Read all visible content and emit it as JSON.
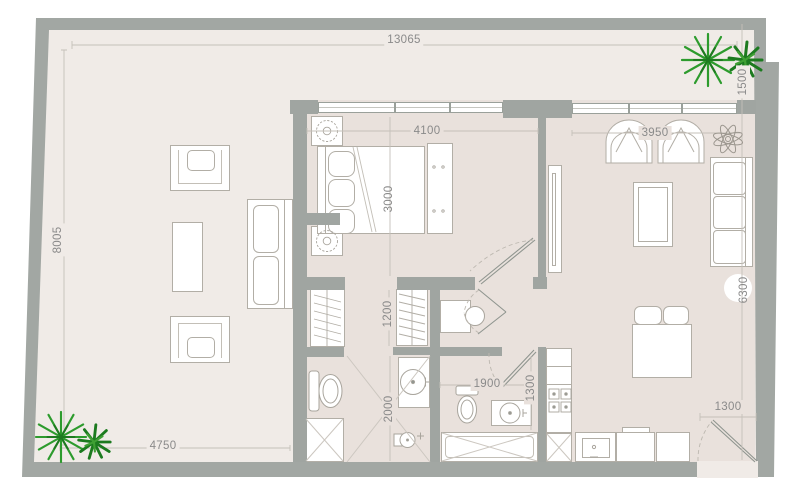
{
  "floor_plan": {
    "dimensions": {
      "overall_top": "13065",
      "left_side": "8005",
      "terrace_bottom": "4750",
      "balcony_right": "1500",
      "bedroom_width": "4100",
      "bedroom_depth": "3000",
      "living_width": "3950",
      "living_depth": "6300",
      "closet_depth": "1200",
      "master_bath_depth": "2000",
      "guest_bath_width": "1900",
      "guest_bath_depth": "1300",
      "entry_door_width": "1300"
    },
    "colors": {
      "wall": "#a2a7a3",
      "terrace_floor": "#f0ebe7",
      "interior_floor": "#e9e1dc",
      "dimension_text": "#8a8a8a",
      "plant_green": "#2d9b2d",
      "plant_dark_green": "#1e7a20"
    }
  }
}
